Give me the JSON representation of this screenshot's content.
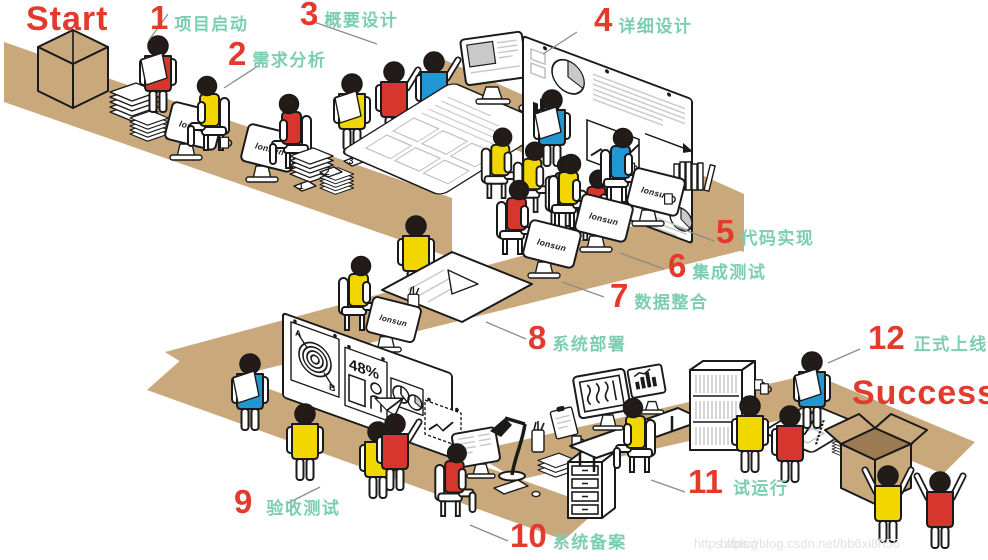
{
  "start_label": "Start",
  "success_label": "Success",
  "brand": "lonsun",
  "steps": [
    {
      "num": "1",
      "label": "项目启动"
    },
    {
      "num": "2",
      "label": "需求分析"
    },
    {
      "num": "3",
      "label": "概要设计"
    },
    {
      "num": "4",
      "label": "详细设计"
    },
    {
      "num": "5",
      "label": "代码实现"
    },
    {
      "num": "6",
      "label": "集成测试"
    },
    {
      "num": "7",
      "label": "数据整合"
    },
    {
      "num": "8",
      "label": "系统部署"
    },
    {
      "num": "9",
      "label": "验收测试"
    },
    {
      "num": "10",
      "label": "系统备案"
    },
    {
      "num": "11",
      "label": "试运行"
    },
    {
      "num": "12",
      "label": "正式上线"
    }
  ],
  "board": {
    "percent": "48%",
    "letter_a": "A",
    "letter_b": "B"
  },
  "paper_tags": [
    "1",
    "2",
    "3"
  ],
  "watermark": {
    "primary": "https://blog.csdn.net/bb6xi8h56",
    "echo": "https://blog"
  },
  "palette": {
    "red": "#E23B2E",
    "shirt_red": "#D6362E",
    "yellow": "#F2D600",
    "blue": "#2096D3",
    "teal": "#7BCEB2",
    "tan": "#C9A87C",
    "tan_dark": "#9C7B52",
    "ink": "#1A1A1A",
    "leader": "#8C8C8C",
    "watermark_gray": "#E2E2E2"
  }
}
